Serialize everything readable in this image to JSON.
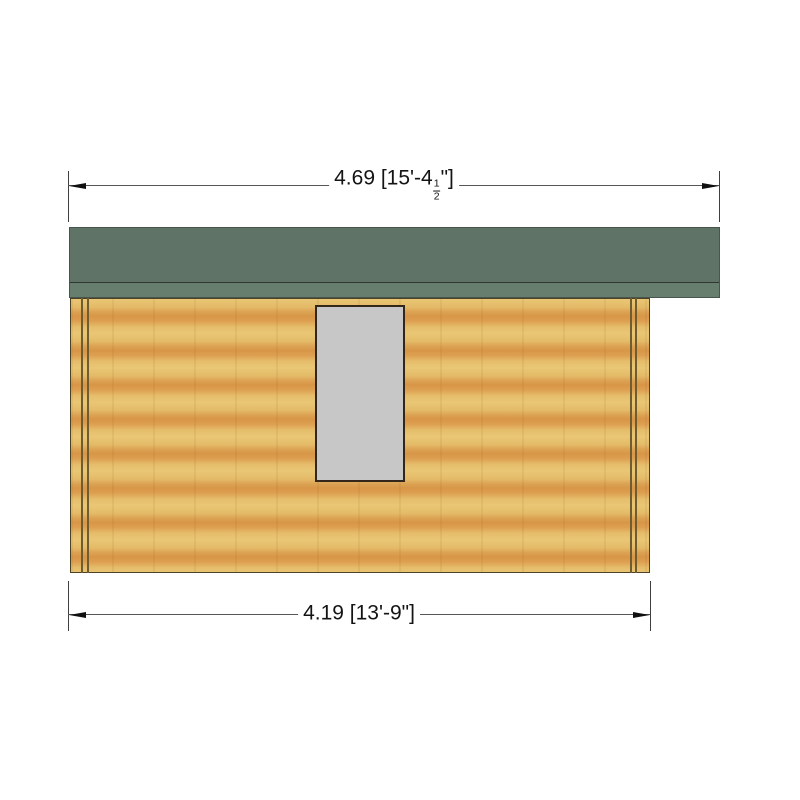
{
  "drawing": {
    "type": "technical-elevation",
    "subject": "log cabin side elevation with roof overhang and window",
    "background_color": "#ffffff"
  },
  "dimensions": {
    "top": {
      "prefix": "4.69 [15'-4",
      "fraction_numerator": "1",
      "fraction_denominator": "2",
      "suffix": "\"]",
      "full_label": "4.69 [15'-4 1/2\"]",
      "measures": "overall width including roof overhang"
    },
    "bottom": {
      "text": "4.19 [13'-9\"]",
      "measures": "wall width"
    }
  },
  "colors": {
    "roof_main": "#5f7366",
    "roof_fascia": "#677d6e",
    "roof_divider_line": "#2c3831",
    "wall_light_wood": "#e9c775",
    "wall_orange_band": "#d89647",
    "corner_joint_line": "#6f5c31",
    "wall_outline": "#4d4126",
    "window_fill": "#c7c7c7",
    "window_border": "#32271a",
    "dimension_line": "#565656",
    "dimension_text": "#141414"
  }
}
